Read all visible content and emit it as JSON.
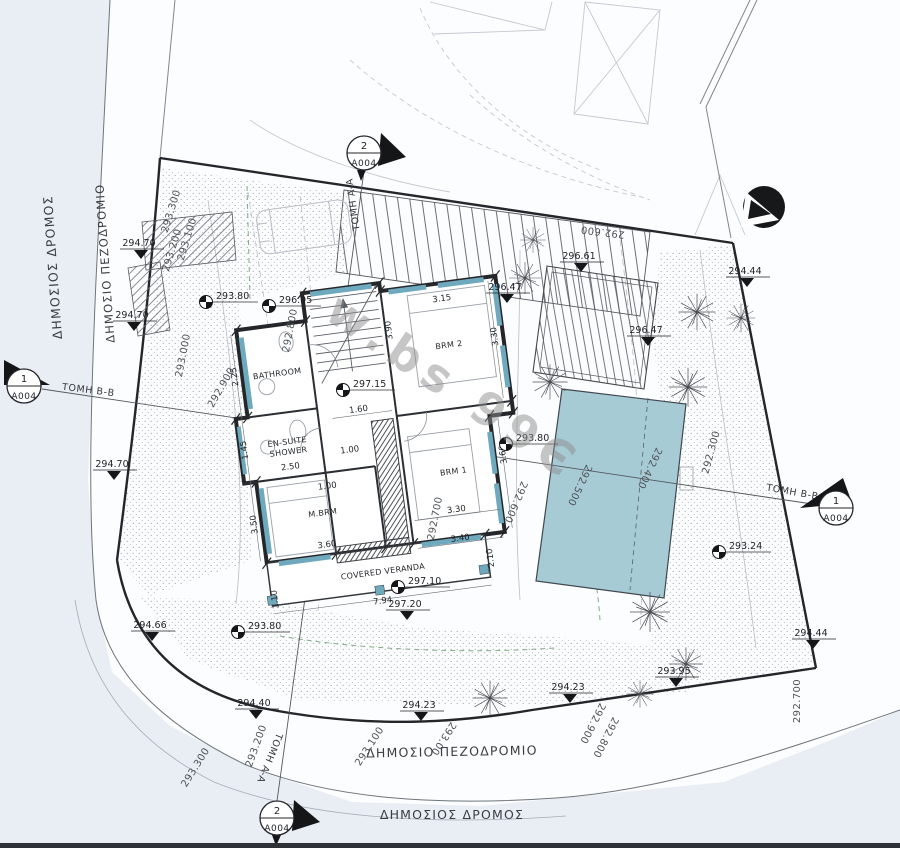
{
  "watermark": "w.bs 99Є",
  "streets": {
    "road_left": "ΔΗΜΟΣΙΟΣ ΔΡΟΜΟΣ",
    "sidewalk_left": "ΔΗΜΟΣΙΟ ΠΕΖΟΔΡΟΜΙΟ",
    "sidewalk_bottom": "ΔΗΜΟΣΙΟ ΠΕΖΟΔΡΟΜΙΟ",
    "road_bottom": "ΔΗΜΟΣΙΟΣ ΔΡΟΜΟΣ"
  },
  "sections": {
    "a_label": "ΤΟΜΗ Α-Α",
    "b_label": "ΤΟΜΗ Β-Β",
    "a_num": "2",
    "b_num": "1",
    "sheet": "A004"
  },
  "rooms": {
    "bathroom": "BATHROOM",
    "ensuite_line1": "EN-SUITE",
    "ensuite_line2": "SHOWER",
    "master": "M.BRM",
    "brm1": "BRM 1",
    "brm2": "BRM 2",
    "veranda": "COVERED VERANDA"
  },
  "dims": {
    "bath_w": "2.25",
    "ensuite_w": "2.50",
    "ensuite_nib": "1.45",
    "master_h": "3.50",
    "master_w": "3.60",
    "stair_h": "3.90",
    "brm2_w": "3.15",
    "brm2_h": "3.30",
    "hall_a": "1.60",
    "hall_b": "1.00",
    "hall_c": "1.00",
    "brm1_w": "3.30",
    "brm1_w2": "3.40",
    "brm1_h": "3.60",
    "ver_l": "1.10",
    "ver_r": "2.10",
    "ver_w": "7.94"
  },
  "spots": {
    "lt1": "294.70",
    "lt2": "294.70",
    "lt3": "294.70",
    "nw1": "293.80",
    "nw2": "296.95",
    "n1": "296.47",
    "deck": "296.61",
    "pergola": "296.47",
    "tr": "294.44",
    "mid": "297.15",
    "pool_w": "293.80",
    "pool_e": "293.24",
    "ver1": "297.10",
    "ver2": "297.20",
    "sw1": "293.80",
    "sw2": "294.66",
    "s1": "294.40",
    "s2": "294.23",
    "s3": "294.23",
    "s4": "293.95",
    "se": "294.44"
  },
  "contours": {
    "l1": "293.300",
    "l2": "293.200",
    "l3": "293.100",
    "l4": "293.000",
    "l5": "292.900",
    "l6": "292.800",
    "m1": "292.700",
    "m2": "292.600",
    "p1": "292.500",
    "p2": "292.400",
    "r1": "292.300",
    "t1": "292.600",
    "r2": "292.700",
    "b1": "293.300",
    "b2": "293.200",
    "b3": "293.100",
    "b4": "293.00",
    "b5": "292.900",
    "b6": "292.800"
  },
  "colors": {
    "pool": "#a7cbd5",
    "window": "#6fa9bd",
    "road_tint": "#e9edf4",
    "paper": "#fcfdfe"
  }
}
